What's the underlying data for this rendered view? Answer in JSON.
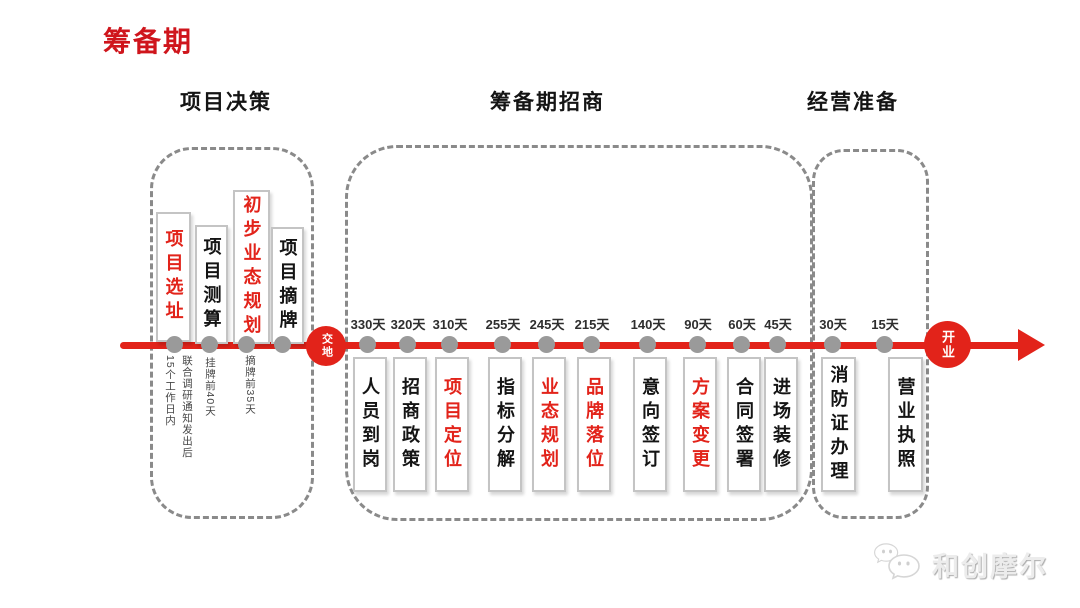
{
  "title": "筹备期",
  "colors": {
    "accent_red": "#e2231a",
    "title_red": "#cf151c",
    "dot_gray": "#9a9a9a",
    "dash_gray": "#8a8a8a"
  },
  "sections": [
    {
      "header": "项目决策"
    },
    {
      "header": "筹备期招商"
    },
    {
      "header": "经营准备"
    }
  ],
  "timeline": {
    "start_label": "交地",
    "end_label": "开业",
    "decision_milestones": [
      {
        "label": "项目选址",
        "highlight": true,
        "note": "联合调研通知发出后15个工作日内"
      },
      {
        "label": "项目测算",
        "highlight": false,
        "note": "挂牌前40天"
      },
      {
        "label": "初步业态规划",
        "highlight": true,
        "note": "摘牌前35天"
      },
      {
        "label": "项目摘牌",
        "highlight": false,
        "note": ""
      }
    ],
    "investment_milestones": [
      {
        "day": "330天",
        "label": "人员到岗",
        "highlight": false
      },
      {
        "day": "320天",
        "label": "招商政策",
        "highlight": false
      },
      {
        "day": "310天",
        "label": "项目定位",
        "highlight": true
      },
      {
        "day": "255天",
        "label": "指标分解",
        "highlight": false
      },
      {
        "day": "245天",
        "label": "业态规划",
        "highlight": true
      },
      {
        "day": "215天",
        "label": "品牌落位",
        "highlight": true
      },
      {
        "day": "140天",
        "label": "意向签订",
        "highlight": false
      },
      {
        "day": "90天",
        "label": "方案变更",
        "highlight": true
      },
      {
        "day": "60天",
        "label": "合同签署",
        "highlight": false
      },
      {
        "day": "45天",
        "label": "进场装修",
        "highlight": false
      }
    ],
    "operation_milestones": [
      {
        "day": "30天",
        "label": "消防证办理",
        "highlight": false
      },
      {
        "day": "15天",
        "label": "营业执照",
        "highlight": false
      }
    ]
  },
  "watermark": {
    "text": "和创摩尔",
    "logo": "chat-bubbles-logo"
  }
}
